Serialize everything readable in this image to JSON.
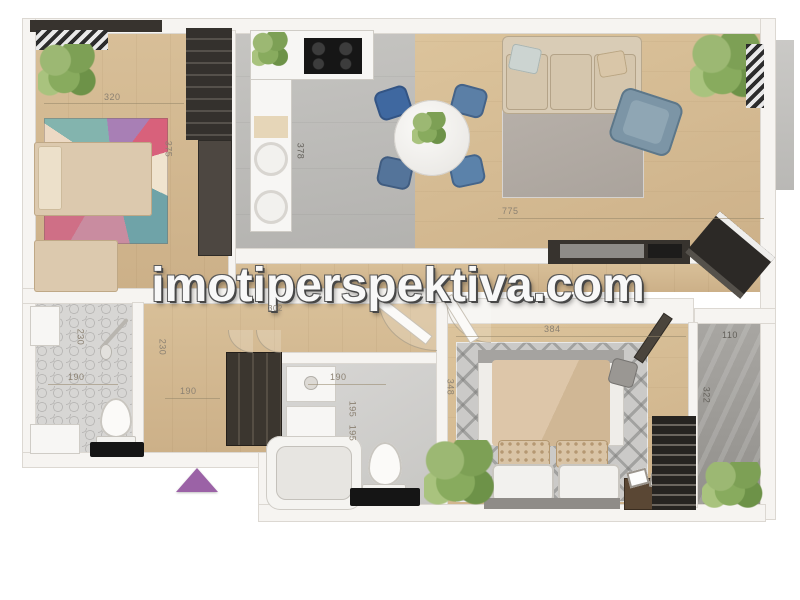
{
  "watermark": {
    "text": "imotiperspektiva.com"
  },
  "branding": {
    "logo_shape": "triangle",
    "logo_color": "#9b62a6"
  },
  "dims": {
    "bedroom1_width": "320",
    "bedroom1_depth": "375",
    "kitchen_depth": "378",
    "living_width": "775",
    "hall_small": "302",
    "bathroom_depth": "230",
    "bathroom_width": "190",
    "hall_depth": "230",
    "hall_width": "190",
    "wc_width": "190",
    "wc_depth_a": "195",
    "wc_depth_b": "195",
    "bedroom2_width": "384",
    "bedroom2_depth": "348",
    "balcony_width": "110",
    "balcony_depth": "322"
  },
  "colors": {
    "wood_floor": "#d3b990",
    "kitchen_tile": "#bdbcb9",
    "bathroom_tile": "#d7d6d4",
    "wc_marble": "#d3d2d0",
    "balcony_concrete": "#a09e9a",
    "accent_blue": "#5b7fa6",
    "sofa_beige": "#d9ccb6",
    "watermark_fill": "#f8f8f8",
    "watermark_outline": "#474747",
    "logo_purple": "#9b62a6"
  }
}
